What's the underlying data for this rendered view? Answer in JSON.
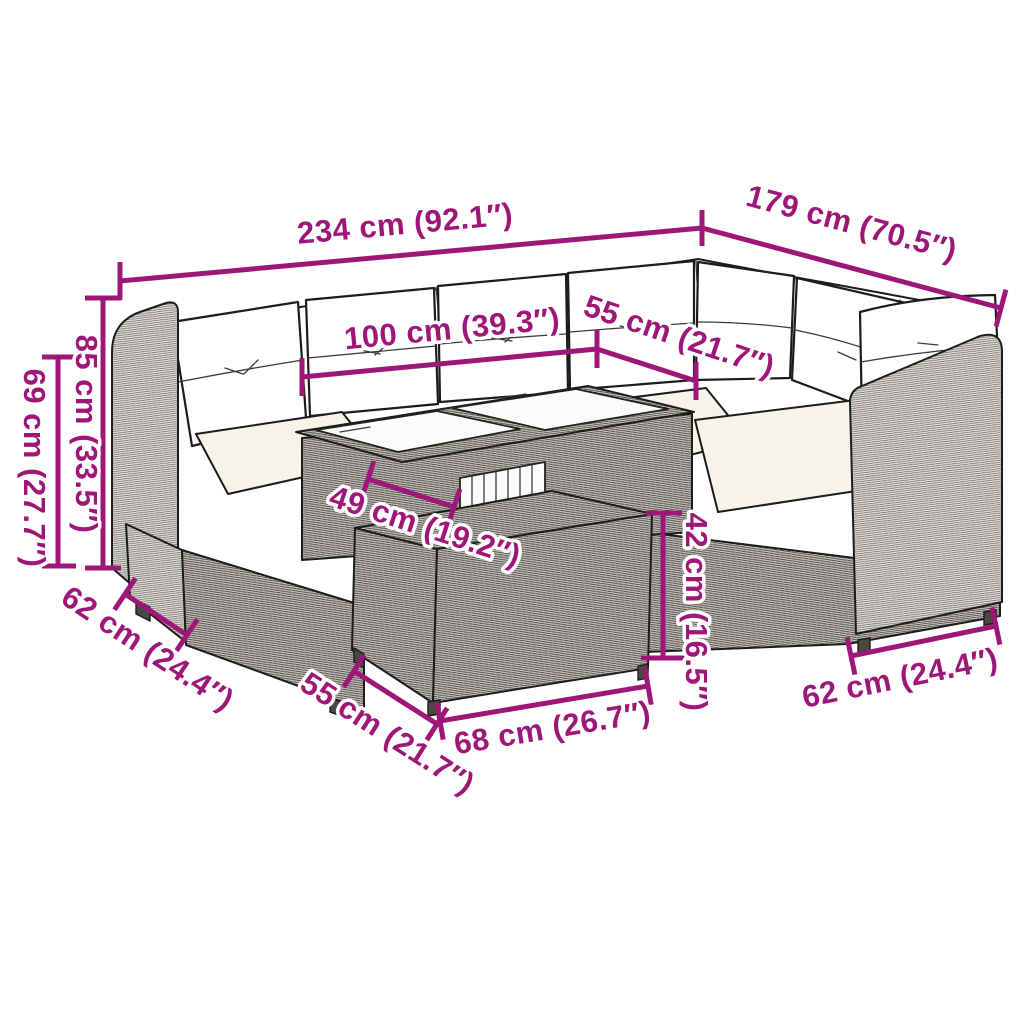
{
  "figure": {
    "name": "rattan-garden-lounge-set-dimension-diagram",
    "parts": [
      "corner-sofa",
      "left-armrest",
      "right-armrest",
      "back-cushions",
      "seat-cushions",
      "glass-top-table",
      "footstool-table"
    ]
  },
  "colors": {
    "accent": "#9E1778",
    "label_halo": "#ffffff",
    "background": "#ffffff",
    "cushion": "#ffffff",
    "seat_cushion": "#f6f3e9",
    "rattan_light": "#e6e4df",
    "rattan_dark": "#d4d1cb",
    "line_art": "#1c1c1c"
  },
  "dimensions": [
    {
      "id": "overall-width",
      "label": "234 cm (92.1″)"
    },
    {
      "id": "overall-depth",
      "label": "179 cm (70.5″)"
    },
    {
      "id": "table-length",
      "label": "100 cm (39.3″)"
    },
    {
      "id": "seat-depth-top",
      "label": "55 cm (21.7″)"
    },
    {
      "id": "back-height",
      "label": "85 cm (33.5″)"
    },
    {
      "id": "arm-height",
      "label": "69 cm (27.7″)"
    },
    {
      "id": "table-width",
      "label": "49 cm (19.2″)"
    },
    {
      "id": "stool-height",
      "label": "42 cm (16.5″)"
    },
    {
      "id": "sofa-depth-left",
      "label": "62 cm (24.4″)"
    },
    {
      "id": "stool-depth",
      "label": "55 cm (21.7″)"
    },
    {
      "id": "stool-width",
      "label": "68 cm (26.7″)"
    },
    {
      "id": "sofa-depth-right",
      "label": "62 cm (24.4″)"
    }
  ]
}
